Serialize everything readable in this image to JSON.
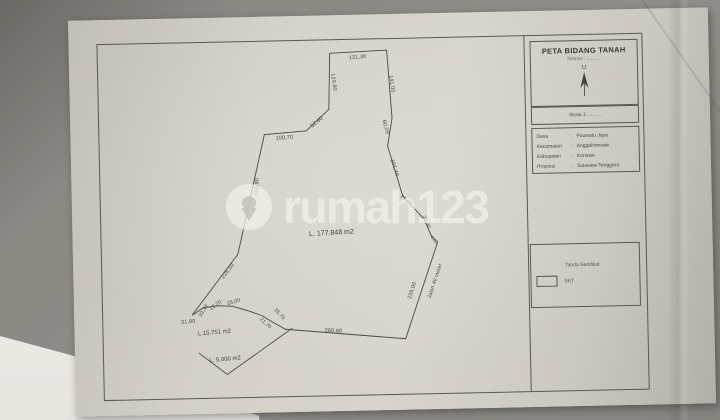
{
  "watermark": {
    "brand": "rumah123"
  },
  "title_block": {
    "title": "PETA BIDANG TANAH",
    "subtitle": "Nomor : ..........",
    "north_label": "U",
    "scale_label": "Skala 1 : ........"
  },
  "location_table": {
    "rows": [
      {
        "label": "Desa",
        "value": "Puuwatu Jaya"
      },
      {
        "label": "Kecamatan",
        "value": "Anggalomoare"
      },
      {
        "label": "Kabupaten",
        "value": "Konawe"
      },
      {
        "label": "Propinsi",
        "value": "Sulawesi Tenggara"
      }
    ]
  },
  "legend_block": {
    "heading": "Tanda Sertifikat",
    "item_label": "SKT"
  },
  "parcels": [
    {
      "id": "main",
      "area_label": "L. 177.848 m2"
    },
    {
      "id": "middle",
      "area_label": "L.15.751 m2"
    },
    {
      "id": "bottom",
      "area_label": "L. 5.000 m2"
    }
  ],
  "road_label": "Jalan 40 meter",
  "measurements": [
    {
      "id": "top",
      "text": "121,30"
    },
    {
      "id": "upper-left",
      "text": "129,80"
    },
    {
      "id": "upper-right",
      "text": "141,00"
    },
    {
      "id": "step",
      "text": "52,60"
    },
    {
      "id": "shoulder",
      "text": "100,70"
    },
    {
      "id": "west",
      "text": "206,90"
    },
    {
      "id": "east-1",
      "text": "60,09"
    },
    {
      "id": "east-2",
      "text": "101,40"
    },
    {
      "id": "east-3",
      "text": "71,60"
    },
    {
      "id": "east-4",
      "text": "36,30"
    },
    {
      "id": "east-5",
      "text": "8,00"
    },
    {
      "id": "road-edge",
      "text": "235,00"
    },
    {
      "id": "south",
      "text": "260,60"
    },
    {
      "id": "south-west-1",
      "text": "21,70"
    },
    {
      "id": "south-west-2",
      "text": "25,70"
    },
    {
      "id": "south-west-3",
      "text": "25,00"
    },
    {
      "id": "south-west-4",
      "text": "12,70"
    },
    {
      "id": "south-west-5",
      "text": "32,30"
    },
    {
      "id": "tip",
      "text": "31,90"
    },
    {
      "id": "diagonal",
      "text": "228,50"
    }
  ]
}
